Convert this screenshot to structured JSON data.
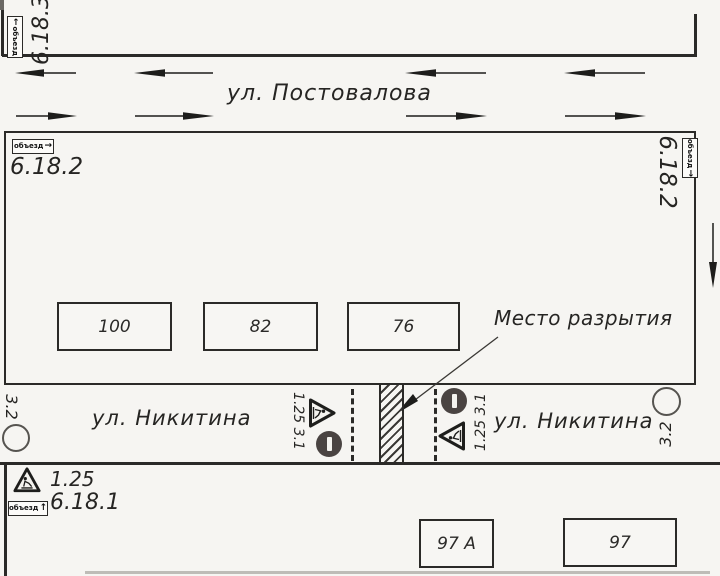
{
  "streets": {
    "postovalova": "ул. Постовалова",
    "nikitina_left": "ул. Никитина",
    "nikitina_right": "ул. Никитина"
  },
  "excavation": {
    "label": "Место разрытия"
  },
  "buildings": {
    "b100": "100",
    "b82": "82",
    "b76": "76",
    "b97a": "97 А",
    "b97": "97"
  },
  "codes": {
    "top_left": "6.18.3",
    "main_left": "6.18.2",
    "main_right": "6.18.2",
    "group_left": "1.25 3.1",
    "group_right": "1.25 3.1",
    "no_movement_left": "3.2",
    "no_movement_right": "3.2",
    "legend_roadworks": "1.25",
    "legend_detour": "6.18.1"
  },
  "detour_signs": {
    "top_left": {
      "text": "объезд",
      "arrow": "←"
    },
    "main_left": {
      "text": "объезд",
      "arrow": "→"
    },
    "main_right": {
      "text": "объезд",
      "arrow": "→"
    },
    "legend": {
      "text": "объезд",
      "arrow": "↑"
    }
  },
  "colors": {
    "ink": "#2b2a28",
    "paper": "#f6f5f2",
    "sign_dark": "#4a4442"
  }
}
